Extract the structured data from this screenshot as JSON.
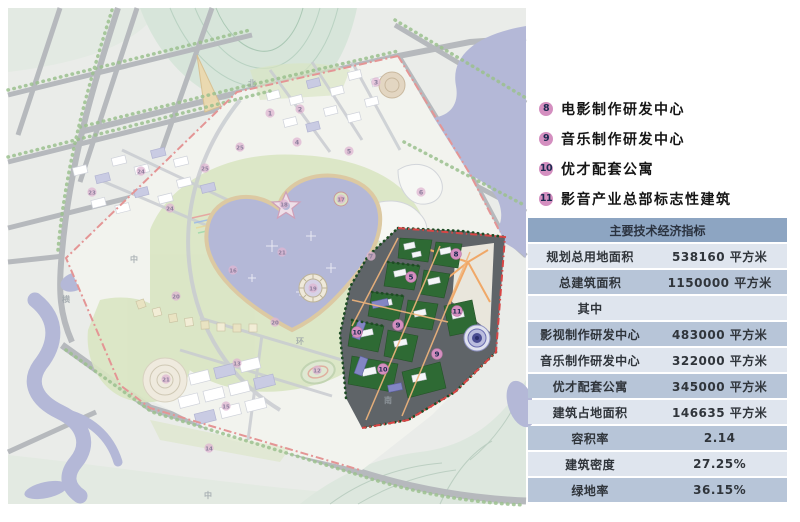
{
  "legend": {
    "items": [
      {
        "num": "8",
        "label": "电影制作研发中心"
      },
      {
        "num": "9",
        "label": "音乐制作研发中心"
      },
      {
        "num": "10",
        "label": "优才配套公寓"
      },
      {
        "num": "11",
        "label": "影音产业总部标志性建筑"
      }
    ]
  },
  "table": {
    "title": "主要技术经济指标",
    "rows": [
      {
        "label": "规划总用地面积",
        "value": "538160 平方米"
      },
      {
        "label": "总建筑面积",
        "value": "1150000 平方米"
      },
      {
        "label": "其中",
        "value": ""
      },
      {
        "label": "影视制作研发中心",
        "value": "483000 平方米"
      },
      {
        "label": "音乐制作研发中心",
        "value": "322000 平方米"
      },
      {
        "label": "优才配套公寓",
        "value": "345000 平方米"
      },
      {
        "label": "建筑占地面积",
        "value": "146635 平方米"
      },
      {
        "label": "容积率",
        "value": "2.14"
      },
      {
        "label": "建筑密度",
        "value": "27.25%"
      },
      {
        "label": "绿地率",
        "value": "36.15%"
      }
    ]
  },
  "map": {
    "markers_bright": [
      {
        "num": "8",
        "x": 456,
        "y": 254
      },
      {
        "num": "5",
        "x": 411,
        "y": 277
      },
      {
        "num": "11",
        "x": 457,
        "y": 311
      },
      {
        "num": "9",
        "x": 398,
        "y": 325
      },
      {
        "num": "10",
        "x": 357,
        "y": 332
      },
      {
        "num": "9",
        "x": 437,
        "y": 354
      },
      {
        "num": "10",
        "x": 383,
        "y": 369
      }
    ],
    "markers_faded": [
      {
        "num": "1",
        "x": 270,
        "y": 113
      },
      {
        "num": "2",
        "x": 300,
        "y": 109
      },
      {
        "num": "3",
        "x": 376,
        "y": 82
      },
      {
        "num": "4",
        "x": 297,
        "y": 142
      },
      {
        "num": "5",
        "x": 349,
        "y": 151
      },
      {
        "num": "6",
        "x": 421,
        "y": 192
      },
      {
        "num": "7",
        "x": 371,
        "y": 256
      },
      {
        "num": "25",
        "x": 240,
        "y": 147
      },
      {
        "num": "25",
        "x": 205,
        "y": 168
      },
      {
        "num": "23",
        "x": 92,
        "y": 192
      },
      {
        "num": "24",
        "x": 170,
        "y": 208
      },
      {
        "num": "24",
        "x": 141,
        "y": 171
      },
      {
        "num": "18",
        "x": 284,
        "y": 204
      },
      {
        "num": "17",
        "x": 341,
        "y": 199
      },
      {
        "num": "21",
        "x": 282,
        "y": 252
      },
      {
        "num": "19",
        "x": 313,
        "y": 288
      },
      {
        "num": "16",
        "x": 233,
        "y": 270
      },
      {
        "num": "20",
        "x": 275,
        "y": 322
      },
      {
        "num": "20",
        "x": 176,
        "y": 296
      },
      {
        "num": "21",
        "x": 166,
        "y": 379
      },
      {
        "num": "13",
        "x": 237,
        "y": 363
      },
      {
        "num": "12",
        "x": 317,
        "y": 370
      },
      {
        "num": "15",
        "x": 226,
        "y": 406
      },
      {
        "num": "14",
        "x": 209,
        "y": 448
      }
    ],
    "road_labels": [
      {
        "t": "北",
        "x": 252,
        "y": 86
      },
      {
        "t": "中",
        "x": 134,
        "y": 262
      },
      {
        "t": "横",
        "x": 66,
        "y": 302
      },
      {
        "t": "环",
        "x": 300,
        "y": 344
      },
      {
        "t": "南",
        "x": 388,
        "y": 403
      },
      {
        "t": "中",
        "x": 208,
        "y": 498
      }
    ]
  },
  "colors": {
    "badge-pink": "#d48fc0",
    "badge-text": "#1c2a50",
    "tbl-header": "#8da5c2",
    "row-med": "#b7c5d8",
    "row-light": "#dfe5ee",
    "boundary-red": "#d84545",
    "highlight-green": "#2e6a34",
    "water-lavender": "#b4b8d7"
  }
}
